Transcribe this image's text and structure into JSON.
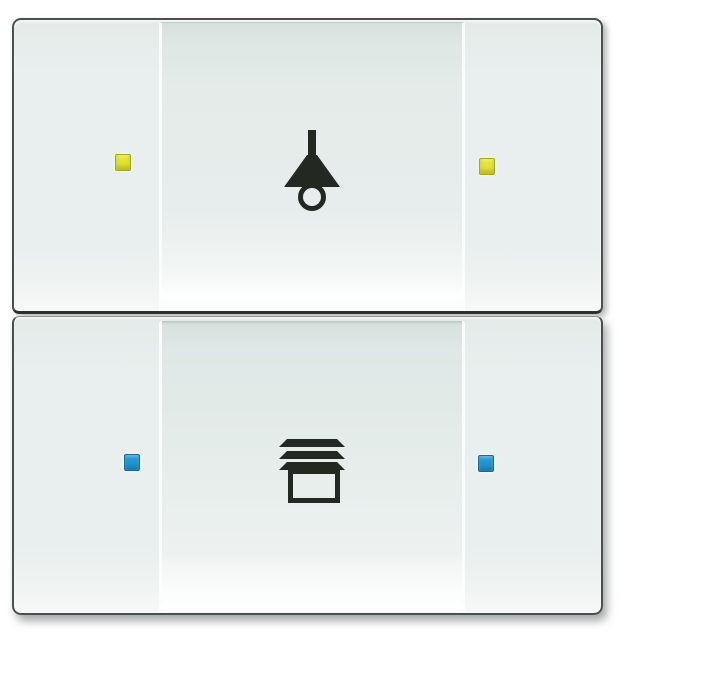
{
  "meta": {
    "description": "Two-gang KNX wall push-button sensor, white glass finish, light rocker above blind rocker",
    "background_color": "#ffffff"
  },
  "device": {
    "frame_color": "#4b504e",
    "rocker_color": "#e9efee",
    "field_top_shade": "#d5e0dd",
    "gloss_highlight": "#fdfefe",
    "modules": [
      {
        "name": "light-control",
        "icon": "pendant-lamp-icon",
        "icon_color": "#232823",
        "led_color": "#e4e531",
        "led_positions": [
          "left",
          "right"
        ]
      },
      {
        "name": "blind-control",
        "icon": "blinds-icon",
        "icon_color": "#232823",
        "led_color": "#2196d3",
        "led_positions": [
          "left",
          "right"
        ]
      }
    ]
  }
}
